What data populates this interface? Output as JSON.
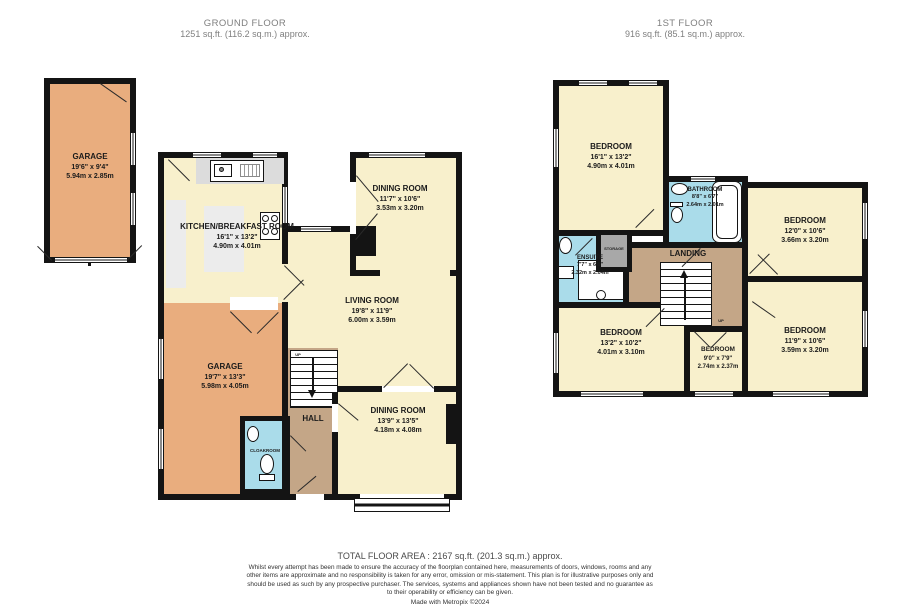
{
  "ground_floor": {
    "title": "GROUND FLOOR",
    "area": "1251 sq.ft. (116.2 sq.m.) approx.",
    "rooms": {
      "garage_top": {
        "name": "GARAGE",
        "imperial": "19'6\" x 9'4\"",
        "metric": "5.94m x 2.85m"
      },
      "kitchen": {
        "name": "KITCHEN/BREAKFAST ROOM",
        "imperial": "16'1\" x 13'2\"",
        "metric": "4.90m x 4.01m"
      },
      "dining_top": {
        "name": "DINING ROOM",
        "imperial": "11'7\" x 10'6\"",
        "metric": "3.53m x 3.20m"
      },
      "living": {
        "name": "LIVING ROOM",
        "imperial": "19'8\" x 11'9\"",
        "metric": "6.00m x 3.59m"
      },
      "garage_main": {
        "name": "GARAGE",
        "imperial": "19'7\" x 13'3\"",
        "metric": "5.98m x 4.05m"
      },
      "hall": {
        "name": "HALL"
      },
      "cloakroom": {
        "name": "CLOAKROOM"
      },
      "dining_bottom": {
        "name": "DINING ROOM",
        "imperial": "13'9\" x 13'5\"",
        "metric": "4.18m x 4.08m"
      },
      "up": "UP"
    }
  },
  "first_floor": {
    "title": "1ST FLOOR",
    "area": "916 sq.ft. (85.1 sq.m.) approx.",
    "rooms": {
      "bedroom_1": {
        "name": "BEDROOM",
        "imperial": "16'1\" x 13'2\"",
        "metric": "4.90m x 4.01m"
      },
      "bathroom": {
        "name": "BATHROOM",
        "imperial": "8'8\" x 6'7\"",
        "metric": "2.64m x 2.01m"
      },
      "bedroom_2": {
        "name": "BEDROOM",
        "imperial": "12'0\" x 10'6\"",
        "metric": "3.66m x 3.20m"
      },
      "ensuite": {
        "name": "ENSUITE",
        "imperial": "7'7\" x 6'8\"",
        "metric": "2.32m x 2.04m"
      },
      "storage": {
        "name": "STORAGE"
      },
      "landing": {
        "name": "LANDING"
      },
      "bedroom_3": {
        "name": "BEDROOM",
        "imperial": "13'2\" x 10'2\"",
        "metric": "4.01m x 3.10m"
      },
      "bedroom_4": {
        "name": "BEDROOM",
        "imperial": "9'0\" x 7'9\"",
        "metric": "2.74m x 2.37m"
      },
      "bedroom_5": {
        "name": "BEDROOM",
        "imperial": "11'9\" x 10'6\"",
        "metric": "3.59m x 3.20m"
      },
      "up": "UP"
    }
  },
  "footer": {
    "total": "TOTAL FLOOR AREA : 2167 sq.ft. (201.3 sq.m.) approx.",
    "disclaimer": "Whilst every attempt has been made to ensure the accuracy of the floorplan contained here, measurements of doors, windows, rooms and any other items are approximate and no responsibility is taken for any error, omission or mis-statement. This plan is for illustrative purposes only and should be used as such by any prospective purchaser. The services, systems and appliances shown have not been tested and no guarantee as to their operability or efficiency can be given.",
    "credit": "Made with Metropix ©2024"
  },
  "colors": {
    "wall": "#141414",
    "room_cream": "#f8f0cc",
    "garage_orange": "#e9ad7e",
    "hall_tan": "#c4a687",
    "wet_room_blue": "#aadcea",
    "counter_gray": "#dcdcdc",
    "storage_gray": "#a8a8a8"
  }
}
